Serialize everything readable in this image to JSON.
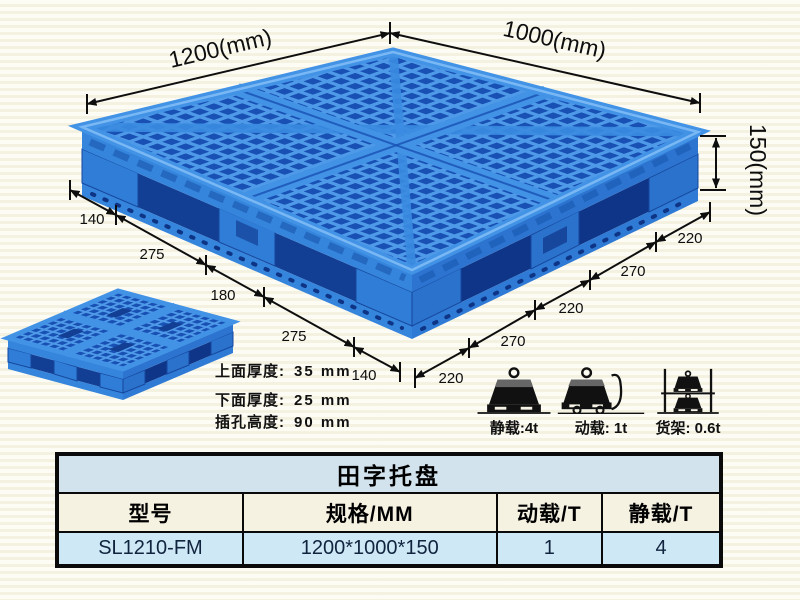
{
  "diagram": {
    "dims": {
      "width_label": "1200(mm)",
      "depth_label": "1000(mm)",
      "height_label": "150(mm)"
    },
    "left_chain": [
      "140",
      "275",
      "180",
      "275",
      "140"
    ],
    "right_chain": [
      "220",
      "270",
      "220",
      "270",
      "220"
    ],
    "specs": [
      {
        "label": "上面厚度:",
        "value": "35 mm"
      },
      {
        "label": "下面厚度:",
        "value": "25 mm"
      },
      {
        "label": "插孔高度:",
        "value": "90 mm"
      }
    ]
  },
  "load_ratings": [
    {
      "icon": "static-load-weight-icon",
      "label": "静载:4t"
    },
    {
      "icon": "dynamic-load-cart-icon",
      "label": "动载: 1t"
    },
    {
      "icon": "rack-load-icon",
      "label": "货架: 0.6t"
    }
  ],
  "table": {
    "title": "田字托盘",
    "headers": [
      "型号",
      "规格/MM",
      "动载/T",
      "静载/T"
    ],
    "rows": [
      [
        "SL1210-FM",
        "1200*1000*150",
        "1",
        "4"
      ]
    ]
  },
  "colors": {
    "pallet_rib_light": "#4f9ae8",
    "pallet_mid": "#3585dc",
    "pallet_hole_dark": "#1850b4",
    "table_title_bg": "#d2e3ee",
    "table_header_bg": "#f6f2e2",
    "table_row_bg": "#cfe8f6"
  }
}
